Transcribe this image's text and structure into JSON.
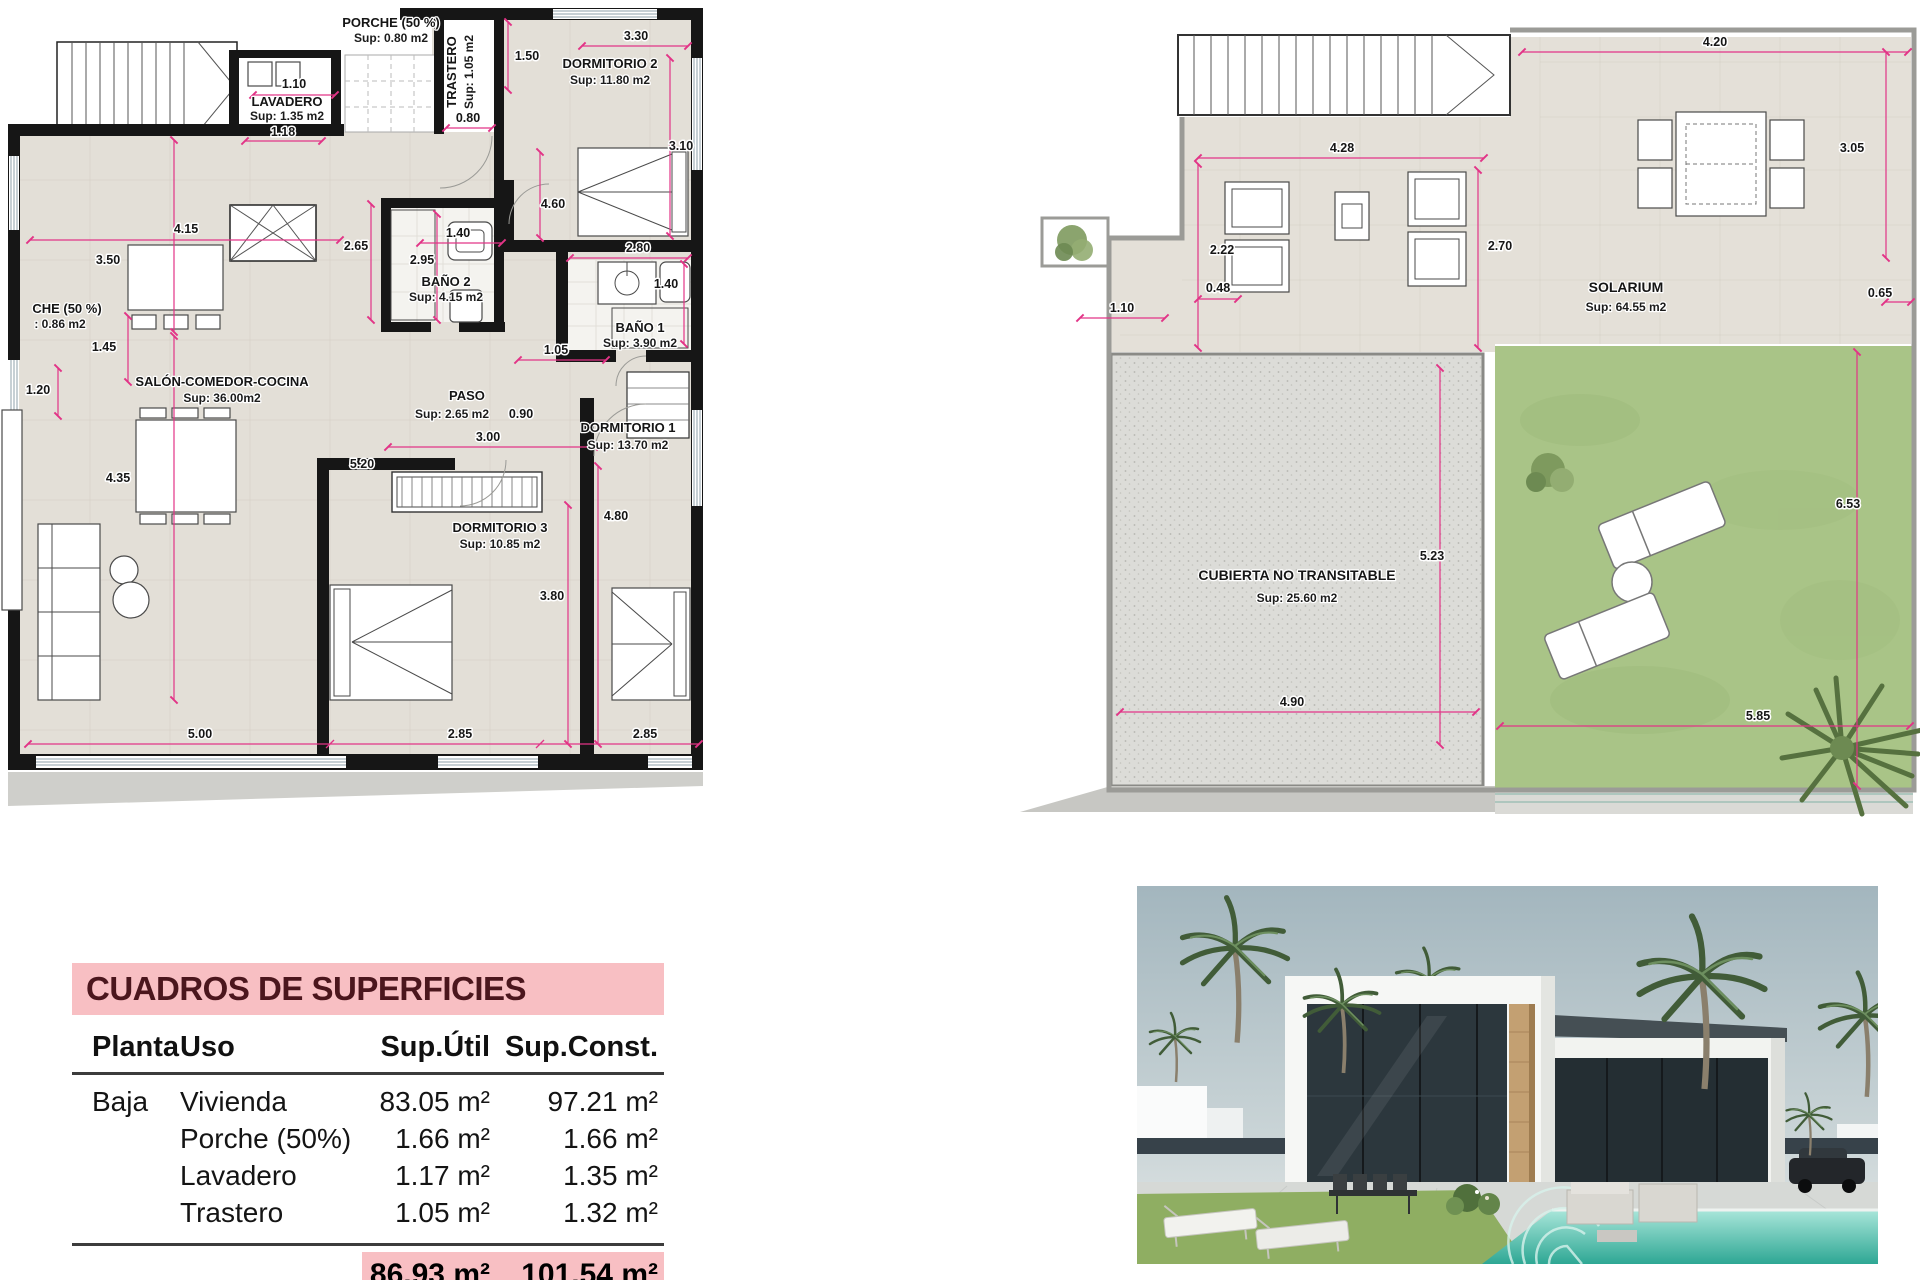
{
  "page": {
    "background": "#ffffff"
  },
  "colors": {
    "dimension_line": "#e23487",
    "wall": "#161616",
    "floor_tile": "#e3dfd7",
    "roof_gravel": "#dcdcd8",
    "lawn": "#a9c487",
    "walkway": "#c7c7c3",
    "table_header_bg": "#f8bfc3",
    "table_header_text": "#4b161d",
    "pool_water": "#2ea794"
  },
  "left_plan": {
    "rooms": {
      "porche_top": {
        "name": "PORCHE (50 %)",
        "sup": "Sup: 0.80 m2"
      },
      "lavadero": {
        "name": "LAVADERO",
        "sup": "Sup: 1.35 m2"
      },
      "trastero": {
        "name": "TRASTERO",
        "sup": "Sup: 1.05 m2"
      },
      "dormitorio2": {
        "name": "DORMITORIO 2",
        "sup": "Sup: 11.80 m2"
      },
      "bano2": {
        "name": "BAÑO 2",
        "sup": "Sup: 4.15 m2"
      },
      "bano1": {
        "name": "BAÑO 1",
        "sup": "Sup: 3.90 m2"
      },
      "salon": {
        "name": "SALÓN-COMEDOR-COCINA",
        "sup": "Sup: 36.00m2"
      },
      "paso": {
        "name": "PASO",
        "sup": "Sup: 2.65 m2"
      },
      "dormitorio3": {
        "name": "DORMITORIO 3",
        "sup": "Sup: 10.85 m2"
      },
      "dormitorio1": {
        "name": "DORMITORIO 1",
        "sup": "Sup: 13.70 m2"
      },
      "porche_left": {
        "name": "CHE (50 %)",
        "sup": ": 0.86 m2"
      }
    },
    "dims": {
      "lavadero_top": "1.10",
      "lavadero_bottom": "1.18",
      "kitchen_width": "4.15",
      "kitchen_height": "3.50",
      "porch_a": "1.45",
      "porch_b": "1.20",
      "salon_height": "4.35",
      "salon_width": "5.00",
      "hall_a": "2.65",
      "hall_b": "2.95",
      "hall_pass": "1.40",
      "trastero_h": "1.50",
      "trastero_w": "0.80",
      "dorm2_w": "3.30",
      "dorm2_h": "3.10",
      "dorm2_v": "4.60",
      "bano1_w": "2.80",
      "bano1_h": "1.40",
      "door_a": "1.05",
      "paso_extra": "0.90",
      "paso_w": "3.00",
      "dorm3_h": "5.20",
      "dorm3_v": "3.80",
      "dorm1_h": "4.80",
      "dorm3_w": "2.85",
      "dorm1_w": "2.85"
    }
  },
  "right_plan": {
    "rooms": {
      "solarium": {
        "name": "SOLARIUM",
        "sup": "Sup: 64.55 m2"
      },
      "cubierta": {
        "name": "CUBIERTA NO TRANSITABLE",
        "sup": "Sup: 25.60 m2"
      }
    },
    "dims": {
      "solarium_top": "4.20",
      "solarium_right": "3.05",
      "kitchen_w": "4.28",
      "kitchen_h": "2.22",
      "solarium_mid": "2.70",
      "step_a": "0.48",
      "planter_w": "1.10",
      "edge": "0.65",
      "cubierta_h": "5.23",
      "lawn_h": "6.53",
      "cubierta_w": "4.90",
      "lawn_w": "5.85"
    }
  },
  "surface_table": {
    "title": "CUADROS DE SUPERFICIES",
    "columns": [
      "Planta",
      "Uso",
      "Sup.Útil",
      "Sup.Const."
    ],
    "rows": [
      {
        "planta": "Baja",
        "uso": "Vivienda",
        "util": "83.05 m²",
        "const": "97.21 m²"
      },
      {
        "planta": "",
        "uso": "Porche (50%)",
        "util": "1.66 m²",
        "const": "1.66 m²"
      },
      {
        "planta": "",
        "uso": "Lavadero",
        "util": "1.17 m²",
        "const": "1.35 m²"
      },
      {
        "planta": "",
        "uso": "Trastero",
        "util": "1.05 m²",
        "const": "1.32 m²"
      }
    ],
    "total": {
      "util": "86.93 m²",
      "const": "101.54 m²"
    }
  }
}
